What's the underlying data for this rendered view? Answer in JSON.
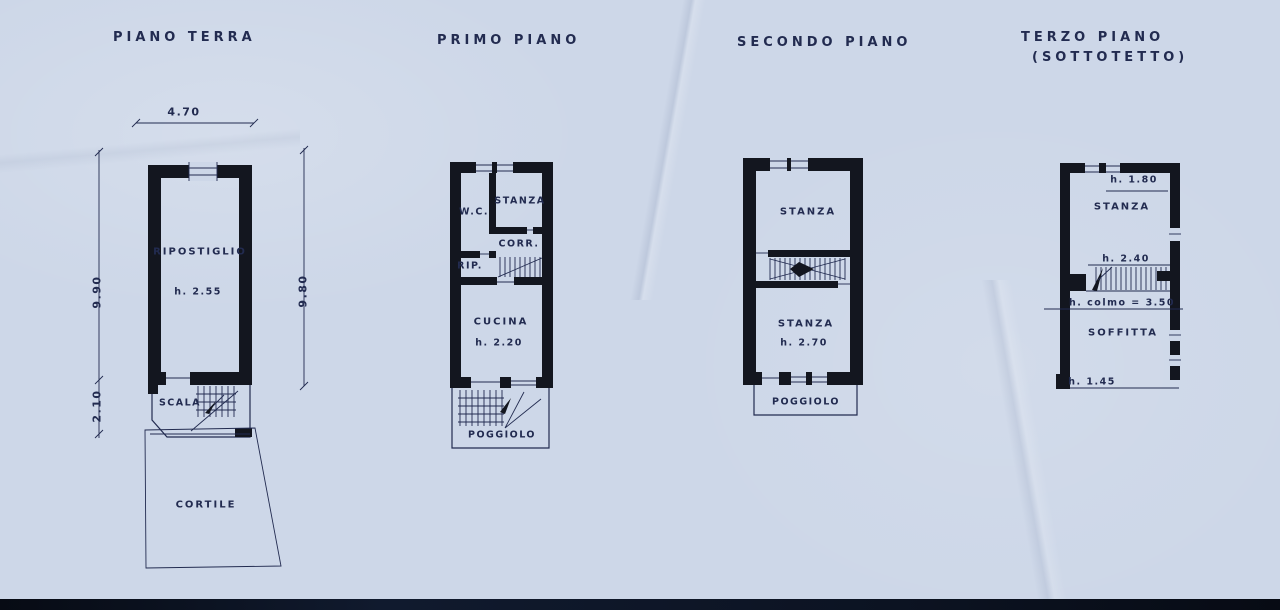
{
  "canvas": {
    "paper_color": "#cdd7e8",
    "ink_color": "#222b50",
    "wall_color": "#13161f"
  },
  "titles": {
    "piano_terra": "PIANO TERRA",
    "primo_piano": "PRIMO PIANO",
    "secondo_piano": "SECONDO PIANO",
    "terzo_piano": "TERZO PIANO",
    "terzo_piano_sub": "(SOTTOTETTO)"
  },
  "piano_terra": {
    "dim_width": "4.70",
    "dim_height_upper_left": "9.90",
    "dim_height_lower_left": "2.10",
    "dim_height_right": "9.80",
    "room_main": "RIPOSTIGLIO",
    "room_main_height": "h. 2.55",
    "room_stairs": "SCALA",
    "courtyard": "CORTILE"
  },
  "primo_piano": {
    "room_wc": "W.C.",
    "room_stanza": "STANZA",
    "room_corridor": "CORR.",
    "room_rip": "RIP.",
    "room_kitchen": "CUCINA",
    "room_kitchen_height": "h. 2.20",
    "balcony": "POGGIOLO"
  },
  "secondo_piano": {
    "room_stanza_top": "STANZA",
    "room_stanza_bottom": "STANZA",
    "room_stanza_bottom_height": "h. 2.70",
    "balcony": "POGGIOLO"
  },
  "terzo_piano": {
    "note_height_top": "h. 1.80",
    "room_stanza": "STANZA",
    "note_height_mid": "h. 2.40",
    "note_ridge_height": "h. colmo = 3.50",
    "room_soffitta": "SOFFITTA",
    "note_height_bottom": "h. 1.45"
  }
}
